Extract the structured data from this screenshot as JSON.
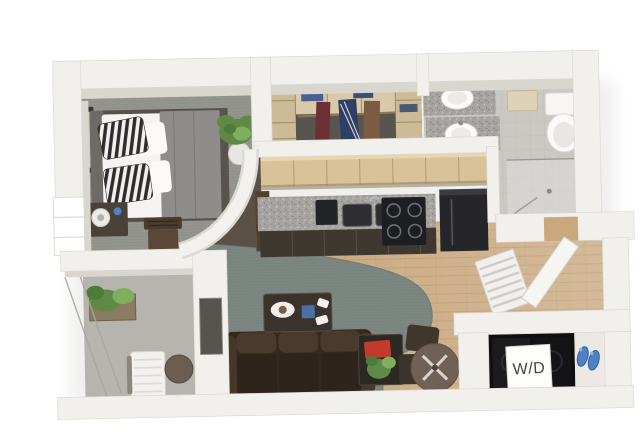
{
  "laundry_sign": {
    "label": "W/D"
  },
  "colors": {
    "background": "#ffffff",
    "wall": "#f2f0ec",
    "wall_shade": "#d9d5cf",
    "bedroom_carpet": "#94958f",
    "living_carpet": "#7d8781",
    "closet_carpet": "#59544e",
    "bathroom_tile": "#cbc8c3",
    "balcony_concrete": "#b6b4af",
    "wood_floor": "#c8a77c",
    "cabinet_wood": "#d9c298",
    "granite": "#a6a4a0",
    "appliance_black": "#26262a",
    "sofa_leather": "#35291f",
    "accent_red": "#c23a2b",
    "plant_green": "#5f8a45",
    "slipper_blue": "#4e82c4",
    "bedding_white": "#f5f4f2",
    "blanket_gray": "#8f8d89"
  }
}
